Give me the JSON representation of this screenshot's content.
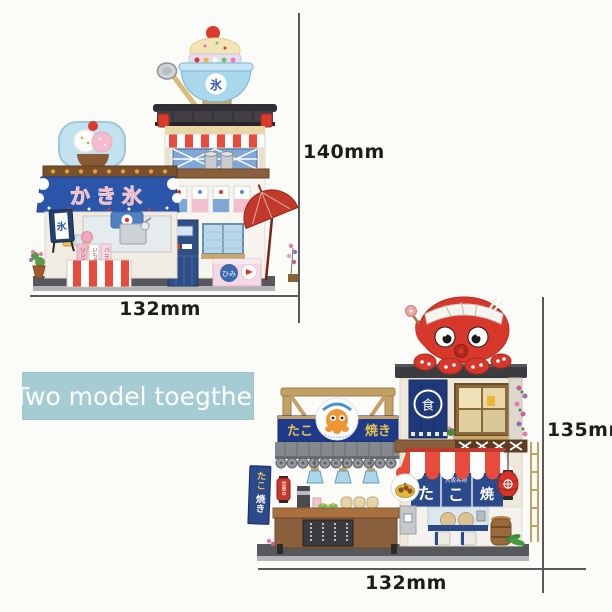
{
  "badge": {
    "label": "Two model toegther",
    "bg": "#a6ccd3",
    "text_color": "#ffffff"
  },
  "dims": {
    "m1_height": "140mm",
    "m1_width": "132mm",
    "m2_height": "135mm",
    "m2_width": "132mm"
  },
  "colors": {
    "dimension_line": "#58585a",
    "label_text": "#1c1c1a",
    "octopus_red": "#d8382c",
    "sign_blue": "#1e3a8a",
    "banner_blue": "#2b55a8"
  },
  "model1": {
    "signs": {
      "main_banner": "かき氷",
      "bowl_kanji": "氷",
      "stand_sign": "氷",
      "secret_sign": "ひみ",
      "flavor_1": "リンゴ",
      "flavor_2": "いちご",
      "flavor_3": "バニラ"
    }
  },
  "model2": {
    "signs": {
      "sign_left": "たこ",
      "sign_right": "焼き",
      "noren_kanji": "食",
      "curtain_subtitle": "大阪名物",
      "curtain_char_1": "た",
      "curtain_char_2": "こ",
      "curtain_char_3": "焼",
      "side_banner_top": "たこ",
      "side_banner_bottom": "焼き",
      "open_lantern": "営業中"
    }
  }
}
